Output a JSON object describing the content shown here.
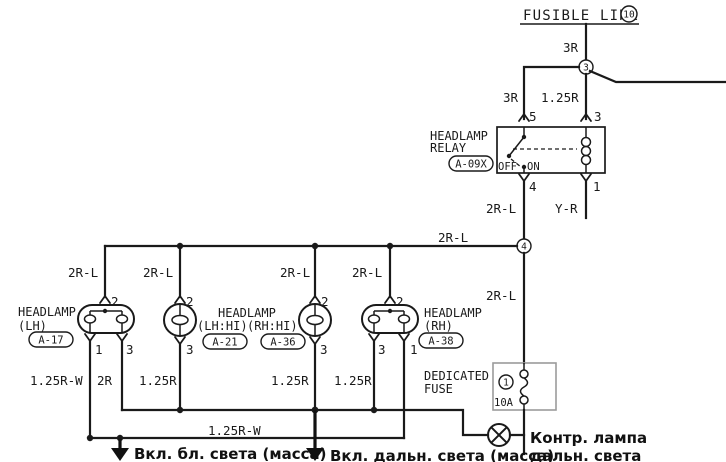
{
  "palette": {
    "line": "#1a1a1a",
    "fuse_box_border": "#9b9b9b",
    "background": "#ffffff"
  },
  "fusible_link": {
    "label": "FUSIBLE LINK",
    "number": "10"
  },
  "junctions": {
    "j3": "3",
    "j4": "4"
  },
  "relay": {
    "title1": "HEADLAMP",
    "title2": "RELAY",
    "connector": "A-09X",
    "off": "OFF",
    "on": "ON",
    "pin5": "5",
    "pin3": "3",
    "pin4": "4",
    "pin1": "1"
  },
  "wires": {
    "r3_top": "3R",
    "r3_left": "3R",
    "r125_relay": "1.25R",
    "rl2_pin4": "2R-L",
    "yr": "Y-R",
    "rl2_bus": "2R-L",
    "rl2_col1": "2R-L",
    "rl2_col2": "2R-L",
    "rl2_col3": "2R-L",
    "rl2_col4": "2R-L",
    "rl2_down": "2R-L",
    "rw125_left": "1.25R-W",
    "r2": "2R",
    "r125_a": "1.25R",
    "r125_b": "1.25R",
    "r125_c": "1.25R",
    "rw125_bottom": "1.25R-W"
  },
  "lamps": {
    "lh": {
      "title": "HEADLAMP",
      "sub": "(LH)",
      "connector": "A-17",
      "pin_top": "2",
      "pin_bl": "1",
      "pin_br": "3"
    },
    "hi": {
      "title": "HEADLAMP",
      "sub_lh": "(LH:HI)",
      "sub_rh": "(RH:HI)",
      "connector_lh": "A-21",
      "connector_rh": "A-36",
      "pin_top_a": "2",
      "pin_bot_a": "3",
      "pin_top_b": "2",
      "pin_bot_b": "3"
    },
    "rh": {
      "title": "HEADLAMP",
      "sub": "(RH)",
      "connector": "A-38",
      "pin_top": "2",
      "pin_bl": "3",
      "pin_br": "1"
    }
  },
  "fuse": {
    "title1": "DEDICATED",
    "title2": "FUSE",
    "number": "1",
    "rating": "10A"
  },
  "annotations": {
    "low_beam_ground": "Вкл. бл. света (масса)",
    "high_beam_ground": "Вкл. дальн. света (масса)",
    "indicator1": "Контр. лампа",
    "indicator2": "дальн. света"
  }
}
